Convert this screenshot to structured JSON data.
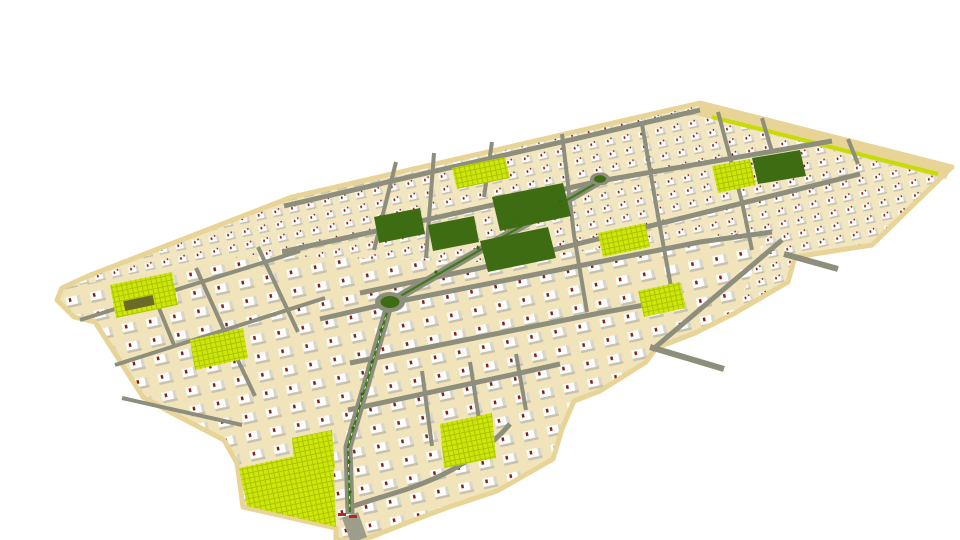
{
  "scene": {
    "description": "Aerial 3D render of a planned residential community masterplan with rows of white villas, a perspective street grid, central parks, bright lawn plots and access roads",
    "view": "birds-eye isometric",
    "background_color": "#ffffff"
  },
  "palette": {
    "ground_tan": "#f2e6c0",
    "edge_beige": "#e8d497",
    "road_grey": "#8e8e7c",
    "road_light": "#9d9d8c",
    "park_green": "#3e6c12",
    "median_green": "#3f7a1c",
    "lawn_chartreuse": "#c6dc05",
    "lawn_texture": "#aac400",
    "tree_green": "#2f6b14",
    "building_white": "#ffffff",
    "building_shade": "#d9d5c7",
    "building_shadow": "#c7c2ae",
    "building_accent": "#8a1c10",
    "gate_red": "#c0251a"
  },
  "features": {
    "roundabout_count": 2,
    "park_blocks": [
      "central-park-1",
      "central-park-2",
      "central-park-3",
      "central-park-4",
      "northeast-park"
    ],
    "lawn_patches": [
      "north-lawn",
      "northeast-edge-strip",
      "east-lawn-upper",
      "east-lawn-lower",
      "west-lawn-1",
      "west-lawn-2",
      "south-lawn-1",
      "south-lawn-2",
      "southwest-field"
    ],
    "roads": [
      "main-boulevard",
      "diagonal-avenue",
      "grid-streets",
      "southeast-edge-road",
      "south-collector-curve",
      "access-spur-east-upper",
      "access-spur-east-lower",
      "south-exit-road"
    ]
  }
}
